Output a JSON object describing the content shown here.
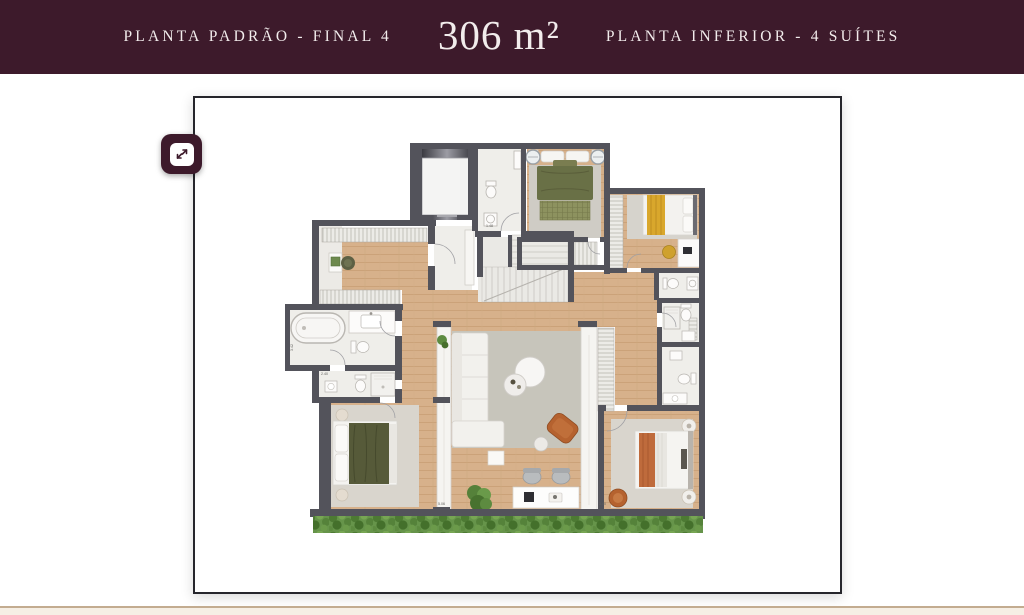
{
  "header": {
    "left_label": "PLANTA PADRÃO - FINAL 4",
    "area_label": "306 m²",
    "right_label": "PLANTA INFERIOR - 4 SUÍTES"
  },
  "viewer": {
    "expand_icon": "expand-arrows"
  },
  "floorplan": {
    "dimension_labels": [
      "5.06",
      "3.40",
      "2.40",
      "3.42",
      "1.48"
    ],
    "rooms": [
      "elevator",
      "lavabo",
      "master-suite",
      "suite-2",
      "suite-3",
      "suite-4",
      "master-bath",
      "wc",
      "bath-2",
      "bath-3",
      "stairs",
      "closet-corridor",
      "living-room",
      "home-office-desk",
      "garden-hedge"
    ]
  },
  "colors": {
    "header_bg": "#3D1A2B",
    "header_text": "#F2ECEC",
    "frame_border": "#26262C",
    "wall": "#53535B",
    "wood_floor": "#D7B18B",
    "bath_floor": "#ECEAE6",
    "living_rug": "#C7C5BB",
    "bedroom_rug": "#D9D5CD",
    "bed_green": "#697046",
    "bed_yellow": "#D9A72C",
    "terracotta": "#B5622F",
    "hedge_green": "#66944A",
    "footer_line": "#C3AC90",
    "footer_bg": "#F6EFE5"
  }
}
